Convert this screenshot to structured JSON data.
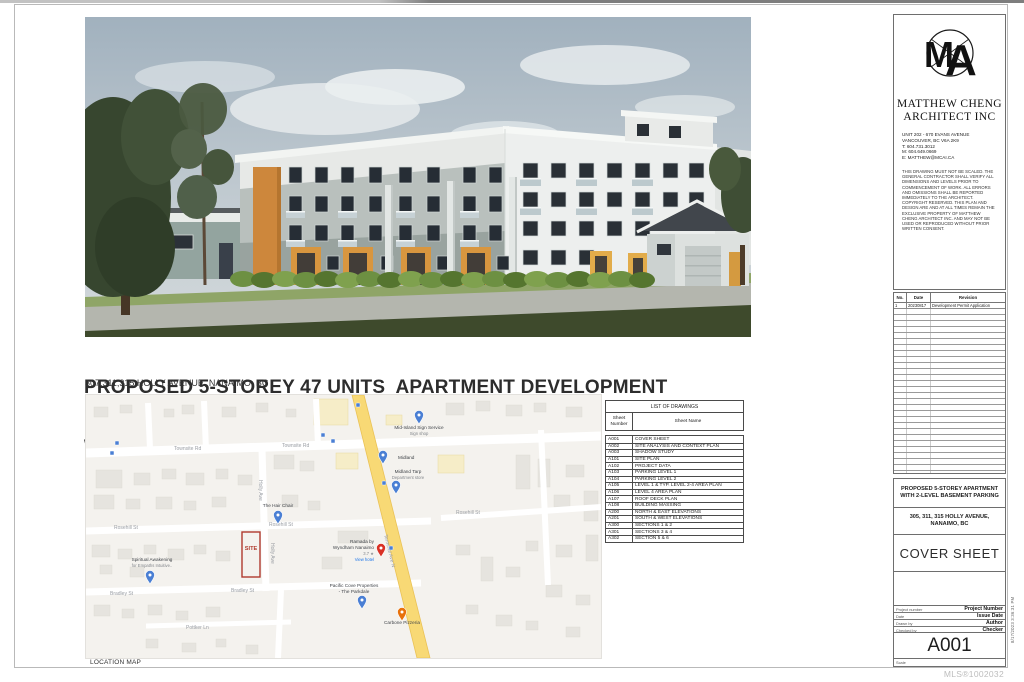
{
  "page": {
    "watermark": "MLS®1002032",
    "plot_stamp": "8/17/2023 3:36:31 PM"
  },
  "cover": {
    "title_line1": "PROPOSED 5-STOREY 47 UNITS  APARTMENT DEVELOPMENT",
    "title_line2": "WITH 2-LEVEL BASEMENT PARKING",
    "address": "307,311,315 HOLLY AVENUE, NANAIMO, BC",
    "location_map_label": "LOCATION MAP"
  },
  "drawing_list": {
    "title": "LIST OF DRAWINGS",
    "col_number": "Sheet Number",
    "col_name": "Sheet Name",
    "rows": [
      {
        "num": "A001",
        "name": "COVER SHEET"
      },
      {
        "num": "A002",
        "name": "SITE ANALYSIS AND CONTEXT PLAN"
      },
      {
        "num": "A003",
        "name": "SHADOW STUDY"
      },
      {
        "num": "A101",
        "name": "SITE PLAN"
      },
      {
        "num": "A102",
        "name": "PROJECT DATA"
      },
      {
        "num": "A103",
        "name": "PARKING LEVEL 1"
      },
      {
        "num": "A104",
        "name": "PARKING LEVEL 2"
      },
      {
        "num": "A105",
        "name": "LEVEL 1 & TYP. LEVEL 2-4 AREA PLAN"
      },
      {
        "num": "A106",
        "name": "LEVEL 4 AREA PLAN"
      },
      {
        "num": "A107",
        "name": "ROOF DECK PLAN"
      },
      {
        "num": "A108",
        "name": "BUILDING MASSING"
      },
      {
        "num": "A200",
        "name": "NORTH & EAST ELEVATIONS"
      },
      {
        "num": "A201",
        "name": "SOUTH & WEST ELEVATIONS"
      },
      {
        "num": "A300",
        "name": "SECTIONS 1 & 2"
      },
      {
        "num": "A301",
        "name": "SECTIONS 3 & 4"
      },
      {
        "num": "A302",
        "name": "SECTION 5 & 6"
      }
    ]
  },
  "titleblock": {
    "firm_line1": "MATTHEW CHENG",
    "firm_line2": "ARCHITECT INC",
    "contact": [
      "UNIT 202 - 670 EVANS AVENUE",
      "VANCOUVER, BC  V6A 2K9",
      "T: 604.731.3012",
      "M: 604.649.0669",
      "E: MATTHEW@MCAI.CA"
    ],
    "disclaimer": "THIS DRAWING MUST NOT BE SCALED. THE GENERAL CONTRACTOR SHALL VERIFY ALL DIMENSIONS AND LEVELS PRIOR TO COMMENCEMENT OF WORK. ALL ERRORS AND OMISSIONS SHALL BE REPORTED IMMEDIATELY TO THE ARCHITECT. COPYRIGHT RESERVED. THIS PLAN AND DESIGN ARE AND AT ALL TIMES REMAIN THE EXCLUSIVE PROPERTY OF MATTHEW CHENG ARCHITECT INC. AND MAY NOT BE USED OR REPRODUCED WITHOUT PRIOR WRITTEN CONSENT.",
    "revisions": {
      "col_no": "No.",
      "col_date": "Date",
      "col_rev": "Revision",
      "rows": [
        {
          "no": "1",
          "date": "20230817",
          "rev": "Development Permit Application"
        }
      ]
    },
    "project_name": "PROPOSED 5-STOREY APARTMENT WITH 2-LEVEL BASEMENT PARKING",
    "project_address": "305, 311, 315 HOLLY AVENUE, NANAIMO, BC",
    "sheet_title": "COVER SHEET",
    "fields": [
      {
        "label": "Project number",
        "value": "Project Number"
      },
      {
        "label": "Date",
        "value": "Issue Date"
      },
      {
        "label": "Drawn by",
        "value": "Author"
      },
      {
        "label": "Checked by",
        "value": "Checker"
      }
    ],
    "sheet_number": "A001",
    "scale_label": "Scale"
  },
  "map": {
    "site_label": "SITE",
    "streets": {
      "townsite": "Townsite Rd",
      "rosehill": "Rosehill St",
      "bradley": "Bradley St",
      "holly": "Holly Ave",
      "terminal": "Terminal Ave N",
      "pottker": "Pottker Ln"
    },
    "pois": {
      "sign_service": "Mid-Island Sign Service",
      "sign_service_sub": "Sign shop",
      "midland": "Midland",
      "midland_tarp": "Midland Tarp",
      "midland_tarp_sub": "Department store",
      "hair_chair": "The Hair Chair",
      "spiritual_1": "Spiritual Awakening",
      "spiritual_2": "for Empaths Intuitive..",
      "ramada_1": "Ramada by",
      "ramada_2": "Wyndham Nanaimo",
      "ramada_rating": "3.7 ★",
      "ramada_link": "View hotel",
      "pacific_1": "Pacific Cove Properties",
      "pacific_2": "- The Parkdale",
      "carbone": "Carbone Pizzeria"
    }
  }
}
